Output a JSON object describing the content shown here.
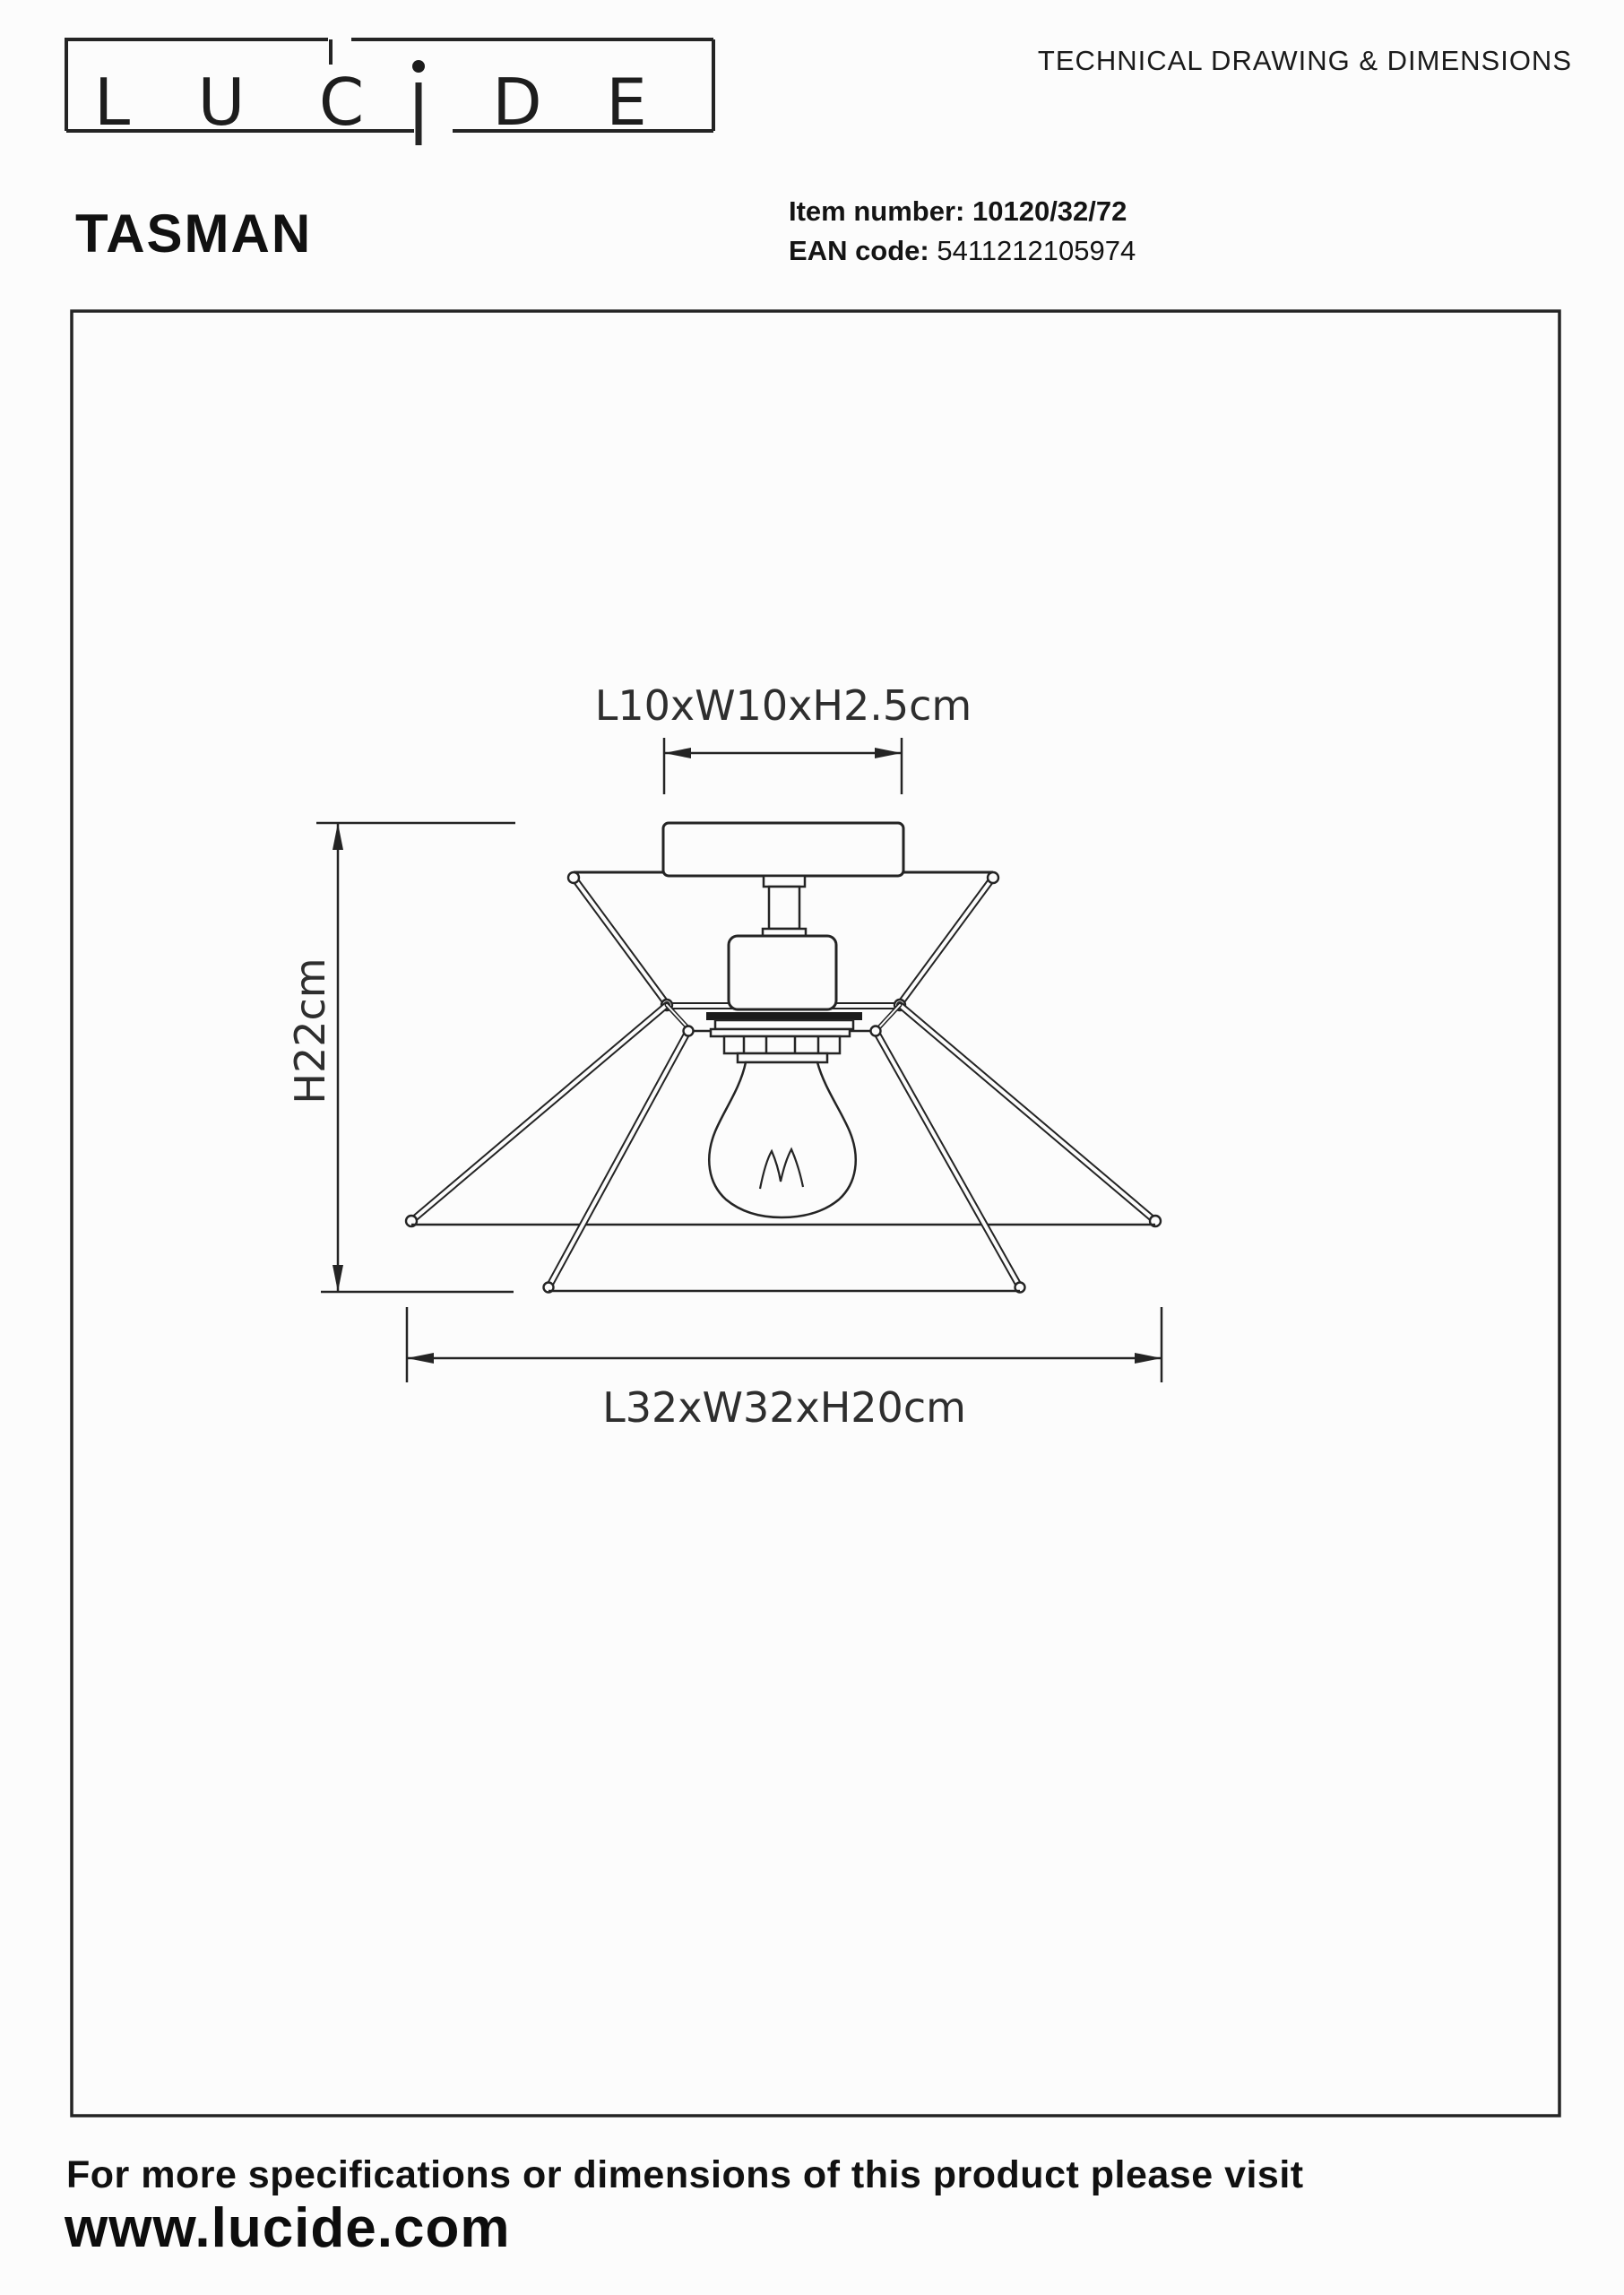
{
  "page": {
    "background": "#fcfcfc",
    "ink": "#242424"
  },
  "header": {
    "logo_letters": [
      "L",
      "U",
      "C",
      "i",
      "D",
      "E"
    ],
    "doc_title": "TECHNICAL DRAWING & DIMENSIONS"
  },
  "product": {
    "name": "TASMAN",
    "item_label": "Item number:",
    "item_value": "10120/32/72",
    "ean_label": "EAN code:",
    "ean_value": "5411212105974"
  },
  "drawing": {
    "dim_canopy": "L10xW10xH2.5cm",
    "dim_height": "H22cm",
    "dim_shade": "L32xW32xH20cm"
  },
  "footer": {
    "line1": "For more specifications or dimensions of this product please visit",
    "line2": "www.lucide.com"
  }
}
